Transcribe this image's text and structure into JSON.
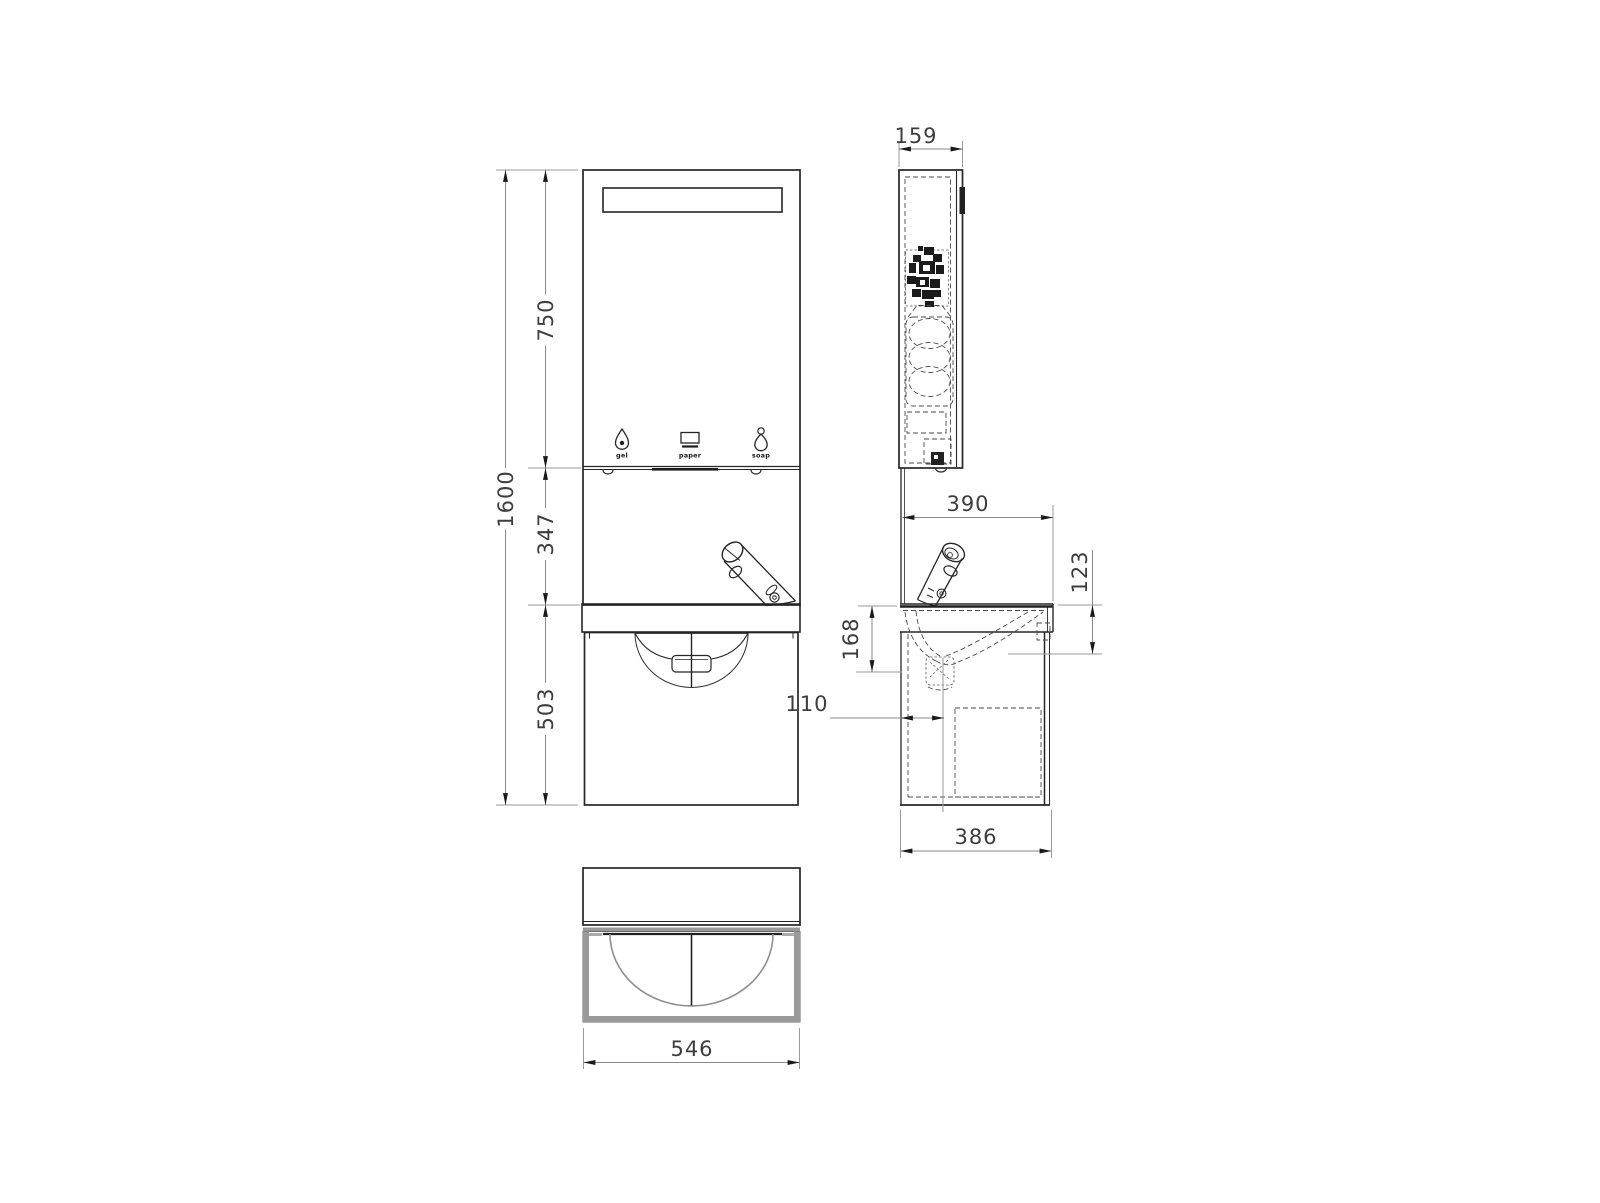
{
  "front_view": {
    "dims": {
      "total_height": "1600",
      "mirror_section": "750",
      "middle_section": "347",
      "cabinet_section": "503"
    },
    "dispenser_labels": {
      "gel": "gel",
      "paper": "paper",
      "soap": "soap"
    }
  },
  "side_view": {
    "dims": {
      "mirror_depth": "159",
      "worktop_depth": "390",
      "apron_height": "123",
      "basin_depth": "168",
      "drain_offset": "110",
      "cabinet_depth": "386"
    }
  },
  "plan_view": {
    "dims": {
      "width": "546"
    }
  },
  "colors": {
    "background": "#ffffff",
    "object_line": "#262626",
    "hidden_line": "#4a4a4a",
    "dimension_line": "#8a8a8a",
    "dimension_text": "#3d3d3d",
    "arrowhead": "#1a1a1a",
    "plan_gray": "#9a9a9a"
  }
}
